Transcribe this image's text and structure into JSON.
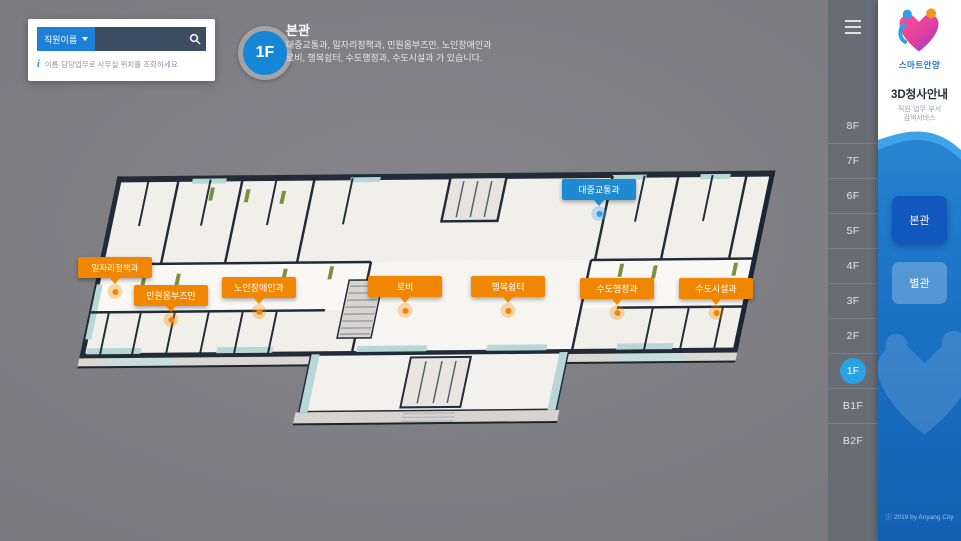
{
  "search": {
    "category_label": "직원이름",
    "input_value": "",
    "hint": "이름·담당업무로 사무실 위치를 조회하세요"
  },
  "floor_header": {
    "badge": "1F",
    "title": "본관",
    "description_line1": "대중교통과, 일자리정책과, 민원옴부즈만, 노인장애인과",
    "description_line2": "로비, 행복쉼터, 수도행정과, 수도시설과 가 있습니다."
  },
  "map": {
    "labels": [
      {
        "text": "일자리정책과",
        "color": "#F18700"
      },
      {
        "text": "민원옴부즈만",
        "color": "#F18700"
      },
      {
        "text": "노인장애인과",
        "color": "#F18700"
      },
      {
        "text": "로비",
        "color": "#F18700"
      },
      {
        "text": "행복쉼터",
        "color": "#F18700"
      },
      {
        "text": "수도행정과",
        "color": "#F18700"
      },
      {
        "text": "수도시설과",
        "color": "#F18700"
      },
      {
        "text": "대중교통과",
        "color": "#1E8AD2"
      }
    ]
  },
  "floor_nav": {
    "items": [
      "8F",
      "7F",
      "6F",
      "5F",
      "4F",
      "3F",
      "2F",
      "1F",
      "B1F",
      "B2F"
    ],
    "selected": "1F"
  },
  "panel": {
    "logo_text": "스마트안양",
    "title": "3D청사안내",
    "subtitle_line1": "직원·업무·부서",
    "subtitle_line2": "검색서비스",
    "building_buttons": [
      {
        "label": "본관",
        "active": true
      },
      {
        "label": "별관",
        "active": false
      }
    ],
    "copyright": "ⓒ 2019 by Anyang City"
  },
  "colors": {
    "accent_orange": "#F18700",
    "accent_blue": "#1E8AD2",
    "selected_floor_blue": "#29A3E3",
    "panel_gradient_top": "#2F97E0",
    "panel_gradient_bottom": "#1160B4"
  }
}
